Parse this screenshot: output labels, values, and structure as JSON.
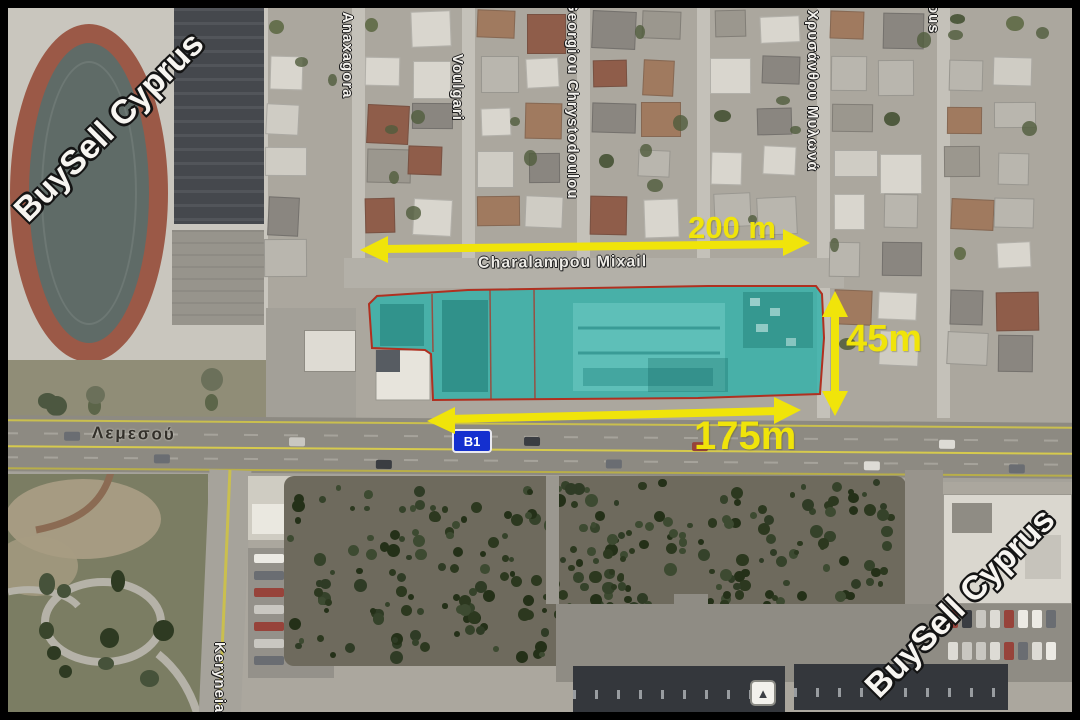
{
  "watermarks": {
    "top_left": "BuySell Cyprus",
    "bottom_right": "BuySell Cyprus"
  },
  "streets": {
    "anaxagora": "Anaxagora",
    "voulgari": "Voulgari",
    "georgiou_chrystodoulou": "Georgiou Chrystodoulou",
    "chrysanthou_mylona": "Χρυσάνθου Μυλωνά",
    "top_right_partial": "ous",
    "keryneias": "Keryneias",
    "lemesou": "Λεμεσού",
    "charalampou_mixail": "Charalampou Mixail"
  },
  "dimensions": {
    "top_width": "200 m",
    "right_depth": "45m",
    "bottom_width": "175m"
  },
  "road_sign": {
    "label": "B1"
  },
  "icons": {
    "marker": "▲"
  },
  "colors": {
    "plot_highlight": "#2bb2aa",
    "plot_outline": "#b03020",
    "dimension_yellow": "#f0e40a",
    "sign_blue": "#1430cf"
  }
}
